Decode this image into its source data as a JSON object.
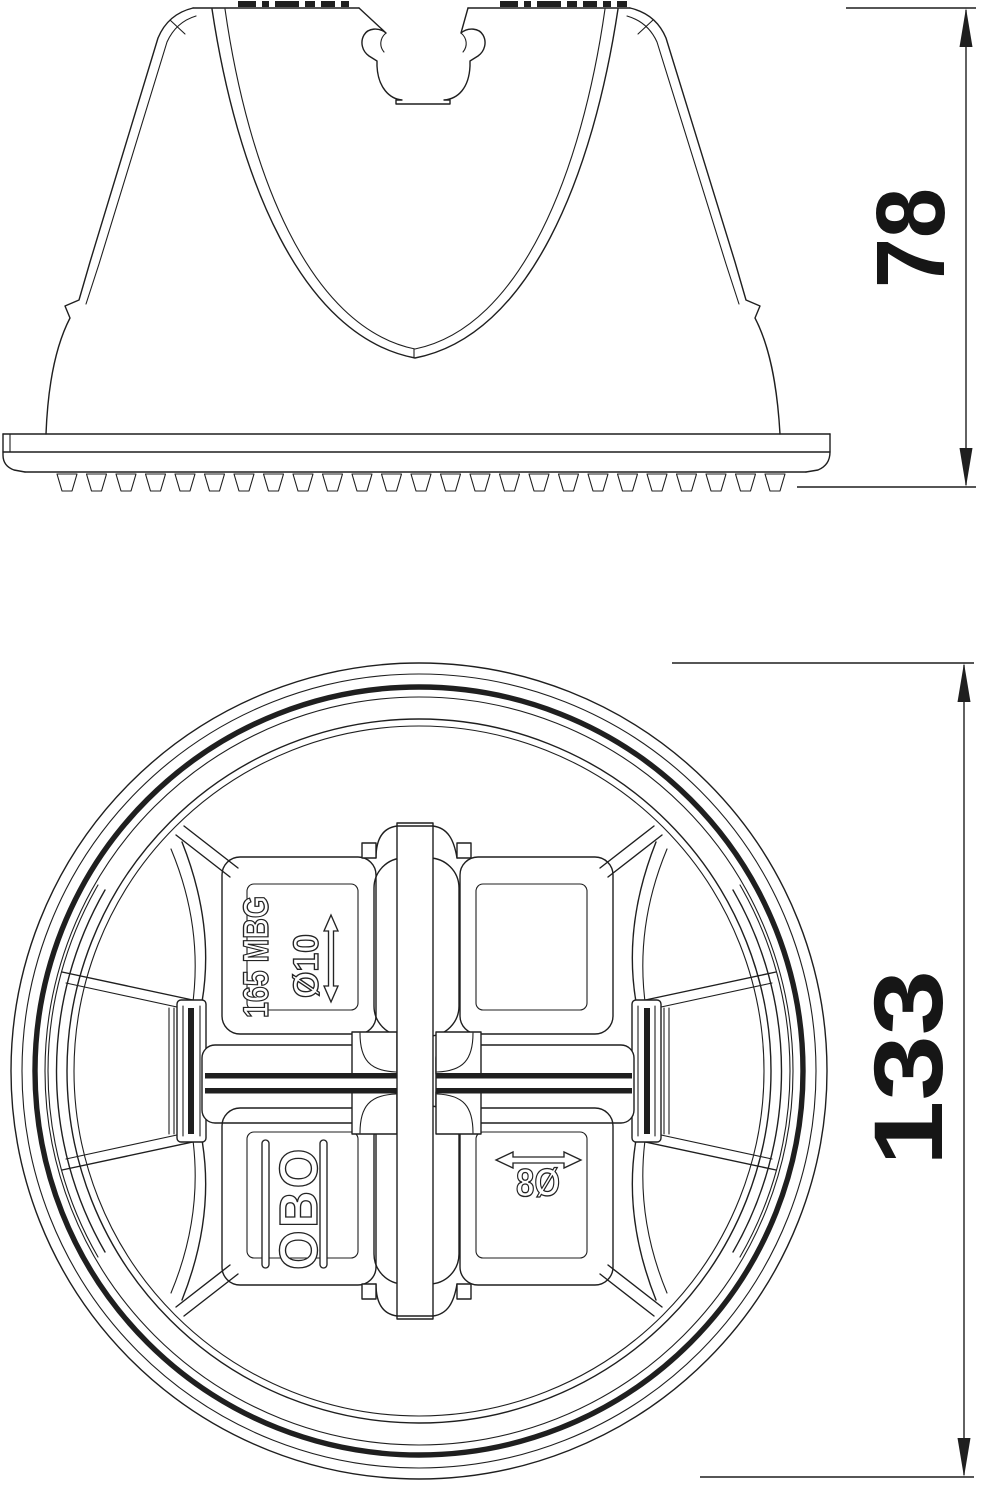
{
  "drawing": {
    "side_view": {
      "height_dim": "78"
    },
    "plan_view": {
      "diameter_dim": "133",
      "type_label": "165 MBG",
      "hole_top_label": "Ø10",
      "brand_label": "OBO",
      "hole_side_label": "8Ø"
    },
    "colors": {
      "line": "#1f1f1f",
      "background": "#ffffff"
    }
  }
}
